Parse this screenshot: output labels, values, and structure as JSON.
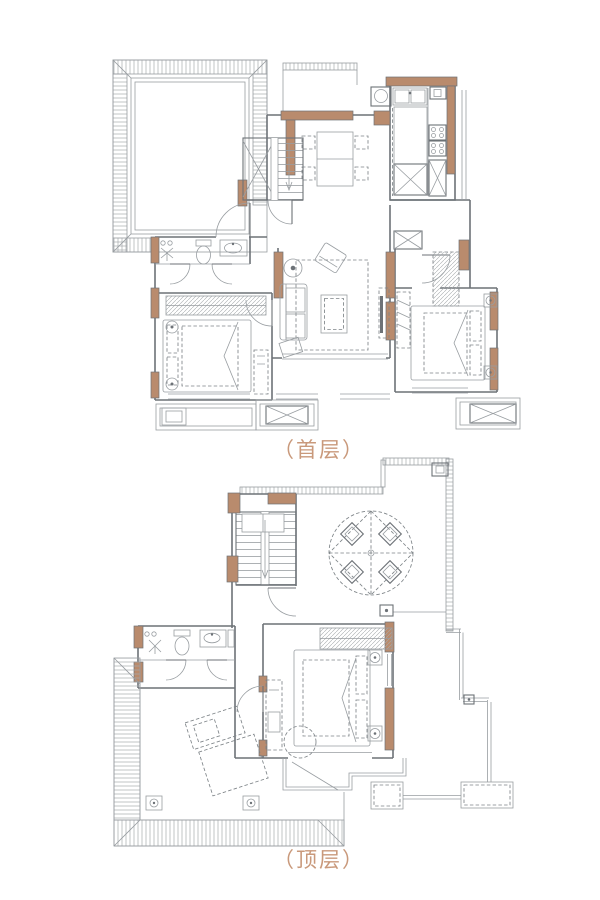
{
  "page": {
    "background": "#ffffff"
  },
  "floors": [
    {
      "id": "floor1",
      "label": "（首层）"
    },
    {
      "id": "floor2",
      "label": "（顶层）"
    }
  ],
  "colors": {
    "wall_fill": "#b98b6d",
    "wall_line": "#6d7277",
    "thin_line": "#989da1",
    "dash_line": "#7e8488",
    "hatch": "#a6abae",
    "label_text": "#c9997b"
  }
}
